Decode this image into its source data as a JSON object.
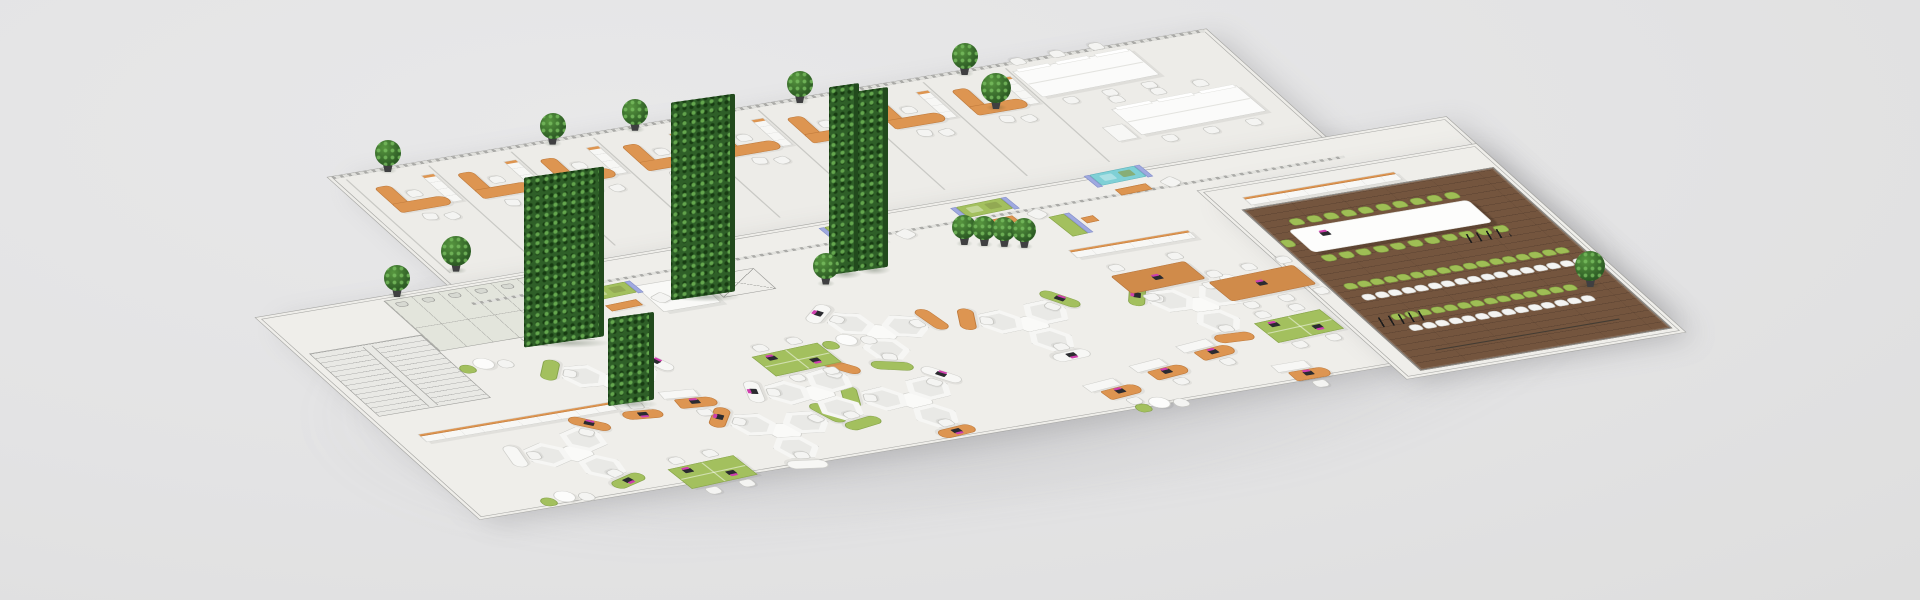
{
  "scene": {
    "width": 1920,
    "height": 600,
    "background": "#e3e3e4",
    "view": "isometric-3d-office-floorplan"
  },
  "palette": {
    "background": "#e3e3e4",
    "floor": "#efeeea",
    "floor_strip": "#edece8",
    "blueprint_floor": "#e9e9e5",
    "bath_floor": "#e3e5dc",
    "wall": "#9a9a97",
    "wall_light": "#c9c9c5",
    "hatch": "#aaaaa7",
    "wood_floor": "#74553e",
    "wood_line": "#5b4230",
    "orange": "#dd9551",
    "orange_dark": "#bf7a3c",
    "green": "#a3c05e",
    "green_dark": "#86a34b",
    "green_chair": "#9fbe55",
    "teal": "#7fd0d6",
    "periwinkle": "#9fa9e0",
    "white_furn": "#f7f7f5",
    "furn_border": "#cfcfcb",
    "chair_white": "#f4f4f2",
    "chair_border": "#c6c6c2",
    "hedge": "#2f5f28",
    "hedge_light": "#4f8f3c",
    "plant": "#356b2c",
    "laptop_base": "#2b2b30",
    "laptop_screen": "#cf3fae",
    "cable": "#1c1c1c"
  },
  "floors": [
    {
      "name": "office-strip-floor",
      "u": 240,
      "v": 0,
      "w": 1090,
      "h": 280,
      "color": "#edece8"
    },
    {
      "name": "main-slab-floor",
      "u": 0,
      "v": 240,
      "w": 1480,
      "h": 440,
      "color": "#efeeea"
    },
    {
      "name": "conference-wing-floor",
      "u": 1140,
      "v": 300,
      "w": 340,
      "h": 410,
      "color": "#efeeea"
    },
    {
      "name": "conference-wood-floor",
      "u": 1160,
      "v": 345,
      "w": 315,
      "h": 358,
      "color": "#74553e",
      "planks": true
    }
  ],
  "blueprint": {
    "stairwell": {
      "u": 10,
      "v": 320,
      "w": 140,
      "h": 140
    },
    "bathrooms": {
      "u": 150,
      "v": 245,
      "w": 200,
      "h": 112
    },
    "core_block": {
      "u": 432,
      "v": 296,
      "w": 72,
      "h": 58
    },
    "shaft": {
      "u": 512,
      "v": 300,
      "w": 66,
      "h": 46
    },
    "door_arcs": [
      {
        "u": 250,
        "v": 358
      },
      {
        "u": 306,
        "v": 362
      }
    ]
  },
  "strip": {
    "u": 240,
    "v": 0,
    "w": 1090,
    "h": 280,
    "partition_us": [
      252,
      355,
      458,
      561,
      664,
      767,
      870,
      973,
      1076
    ]
  },
  "offices": {
    "u_list": [
      262,
      365,
      468,
      571,
      674,
      777,
      880,
      983
    ],
    "v": 22,
    "plant_on": [
      0,
      2,
      3,
      5,
      7
    ]
  },
  "bench_desks": [
    {
      "u": 1080,
      "v": 14,
      "w": 150,
      "h": 58,
      "chairs_top": 3,
      "chairs_bottom": 3,
      "pedestal": false
    },
    {
      "u": 1140,
      "v": 116,
      "w": 160,
      "h": 58,
      "chairs_top": 3,
      "chairs_bottom": 3,
      "pedestal": true
    }
  ],
  "lounges": [
    {
      "u": 368,
      "v": 288,
      "type": "green"
    },
    {
      "u": 700,
      "v": 246,
      "type": "green"
    },
    {
      "u": 862,
      "v": 250,
      "type": "green"
    },
    {
      "u": 1040,
      "v": 232,
      "type": "teal"
    }
  ],
  "booth": {
    "u": 948,
    "v": 298
  },
  "cabinet_rows": [
    {
      "u": 30,
      "v": 505,
      "len": 240
    },
    {
      "u": 930,
      "v": 366,
      "len": 150
    },
    {
      "u": 1175,
      "v": 322,
      "len": 190
    }
  ],
  "hex_clusters": [
    {
      "u": 300,
      "v": 470,
      "rot": 8
    },
    {
      "u": 636,
      "v": 462,
      "rot": 22
    },
    {
      "u": 806,
      "v": 494,
      "rot": -4
    },
    {
      "u": 1008,
      "v": 512,
      "rot": 4
    },
    {
      "u": 176,
      "v": 592,
      "rot": -18
    },
    {
      "u": 420,
      "v": 616,
      "rot": 12
    },
    {
      "u": 594,
      "v": 600,
      "rot": -6
    },
    {
      "u": 500,
      "v": 556,
      "rot": -10
    }
  ],
  "cafe_tables": [
    {
      "u": 170,
      "v": 382
    },
    {
      "u": 100,
      "v": 656
    },
    {
      "u": 580,
      "v": 452
    },
    {
      "u": 836,
      "v": 668
    }
  ],
  "green_benches": [
    {
      "u": 472,
      "v": 466
    },
    {
      "u": 1040,
      "v": 562
    },
    {
      "u": 252,
      "v": 650
    }
  ],
  "desk_units": [
    {
      "u": 332,
      "v": 502,
      "rot": 7
    },
    {
      "u": 786,
      "v": 624,
      "rot": -7
    },
    {
      "u": 858,
      "v": 602,
      "rot": -7
    },
    {
      "u": 930,
      "v": 580,
      "rot": -7
    },
    {
      "u": 1008,
      "v": 646,
      "rot": 0
    }
  ],
  "wood_tables": [
    {
      "u": 944,
      "v": 428,
      "w": 96,
      "h": 40,
      "chairs": 4
    },
    {
      "u": 1040,
      "v": 470,
      "w": 110,
      "h": 44,
      "chairs": 6
    }
  ],
  "conference": {
    "table": {
      "u": 1185,
      "v": 398,
      "w": 225,
      "h": 50
    },
    "laptop": {
      "u": 1215,
      "v": 412
    },
    "side_chair_rows": [
      {
        "color": "green",
        "v": 378,
        "u0": 1196,
        "count": 10,
        "du": 21.5
      },
      {
        "color": "green",
        "v": 456,
        "u0": 1188,
        "count": 11,
        "du": 21.5
      }
    ],
    "end_chair": {
      "u": 1162,
      "v": 416
    },
    "theater_rows": [
      {
        "color": "green",
        "v": 516,
        "u0": 1178,
        "count": 17,
        "du": 16.5
      },
      {
        "color": "white",
        "v": 542,
        "u0": 1184,
        "count": 17,
        "du": 16.5
      },
      {
        "color": "green",
        "v": 588,
        "u0": 1192,
        "count": 14,
        "du": 16.5
      },
      {
        "color": "white",
        "v": 614,
        "u0": 1198,
        "count": 14,
        "du": 16.5
      }
    ],
    "cables": [
      {
        "u": 1172,
        "v": 590,
        "w": 60,
        "h": 20
      },
      {
        "u": 1362,
        "v": 462,
        "w": 52,
        "h": 18
      }
    ],
    "power_track": {
      "u": 1200,
      "v": 668,
      "w": 230
    }
  },
  "hedge_walls": [
    {
      "u": 252,
      "v": 378,
      "w": 80,
      "ht": 170
    },
    {
      "u": 460,
      "v": 336,
      "w": 64,
      "ht": 198
    },
    {
      "u": 652,
      "v": 338,
      "w": 30,
      "ht": 188
    },
    {
      "u": 688,
      "v": 340,
      "w": 30,
      "ht": 180
    },
    {
      "u": 268,
      "v": 514,
      "w": 46,
      "ht": 88
    }
  ],
  "plants": [
    {
      "u": 262,
      "v": 211,
      "s": 30
    },
    {
      "u": 1020,
      "v": 78,
      "s": 30
    },
    {
      "u": 828,
      "v": 322,
      "s": 24
    },
    {
      "u": 848,
      "v": 330,
      "s": 24
    },
    {
      "u": 868,
      "v": 338,
      "s": 24
    },
    {
      "u": 888,
      "v": 346,
      "s": 24
    },
    {
      "u": 636,
      "v": 352,
      "s": 26
    },
    {
      "u": 1438,
      "v": 598,
      "s": 30
    },
    {
      "u": 170,
      "v": 240,
      "s": 26
    }
  ]
}
